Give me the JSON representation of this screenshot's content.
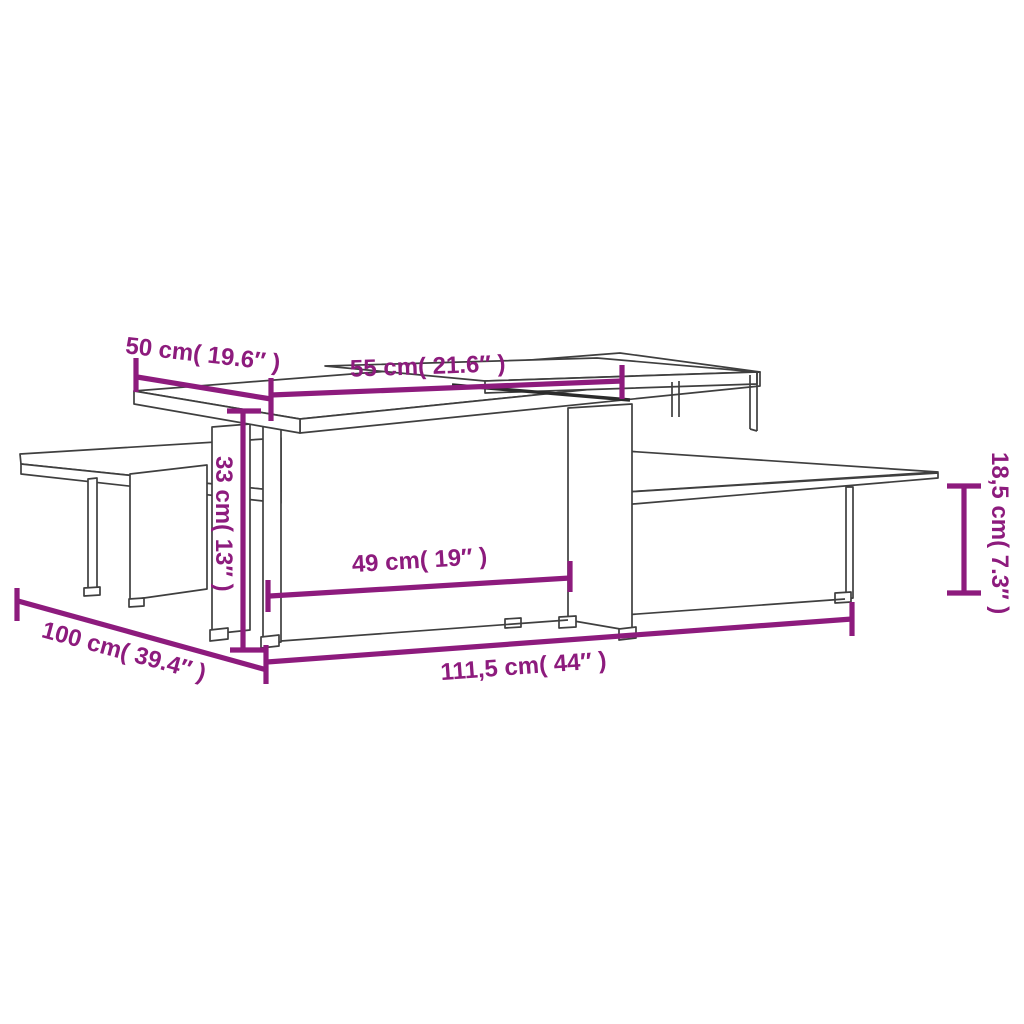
{
  "page": {
    "background": "#ffffff",
    "type": "product-dimension-diagram",
    "subject": "Two interlocking nesting coffee tables, isometric wireframe line drawing with dimension annotations"
  },
  "style": {
    "dimension_color": "#8d1b7d",
    "outline_color": "#3f3f3f"
  },
  "dimensions": {
    "top_depth": {
      "cm": "50",
      "inch": "19.6",
      "label": "50 cm( 19.6″ )"
    },
    "upper_shelf_width": {
      "cm": "55",
      "inch": "21.6",
      "label": "55 cm( 21.6″ )"
    },
    "tall_table_height": {
      "cm": "33",
      "inch": "13",
      "label": "33 cm( 13″ )"
    },
    "inner_width": {
      "cm": "49",
      "inch": "19",
      "label": "49 cm( 19″ )"
    },
    "total_depth": {
      "cm": "100",
      "inch": "39.4",
      "label": "100 cm( 39.4″ )"
    },
    "total_width": {
      "cm": "111,5",
      "inch": "44",
      "label": "111,5 cm( 44″ )"
    },
    "low_table_height": {
      "cm": "18,5",
      "inch": "7.3",
      "label": "18,5 cm( 7.3″ )"
    }
  }
}
